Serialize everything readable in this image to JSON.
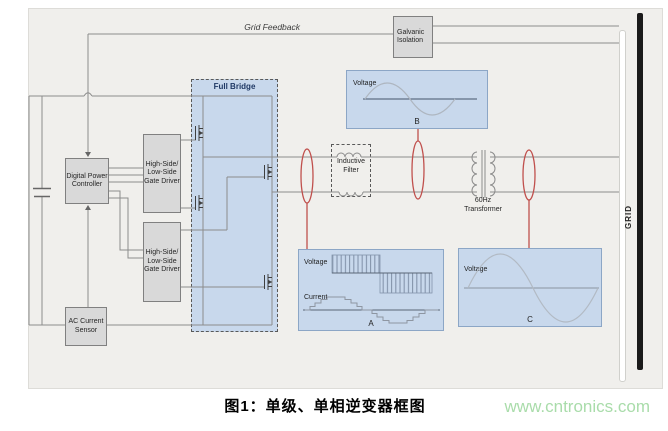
{
  "figure": {
    "caption": "图1：单级、单相逆变器框图",
    "watermark": "www.cntronics.com"
  },
  "blocks": {
    "digital_power_controller": "Digital Power Controller",
    "gate_driver_top": "High-Side/ Low-Side Gate Driver",
    "gate_driver_bottom": "High-Side/ Low-Side Gate Driver",
    "ac_current_sensor": "AC Current Sensor",
    "galvanic_isolation": "Galvanic Isolation",
    "full_bridge": "Full Bridge",
    "inductive_filter": "Inductive Filter",
    "transformer_60hz": "60Hz Transformer",
    "grid": "GRID"
  },
  "annotations": {
    "grid_feedback": "Grid Feedback"
  },
  "waveform_insets": {
    "a": {
      "signal1": "Voltage",
      "signal2": "Current",
      "label": "A"
    },
    "b": {
      "signal1": "Voltage",
      "label": "B"
    },
    "c": {
      "signal1": "Voltage",
      "label": "C"
    }
  },
  "colors": {
    "panel_background": "#f0efec",
    "block_fill_gray": "#d9d9d9",
    "block_border_gray": "#808080",
    "inset_fill_blue": "#c8d8ec",
    "inset_border_blue": "#8ca6c6",
    "wire_gray": "#8c8c8c",
    "probe_red": "#c0504d",
    "grid_bar_black": "#1a1a1a",
    "watermark_green": "#a9dcaa"
  }
}
